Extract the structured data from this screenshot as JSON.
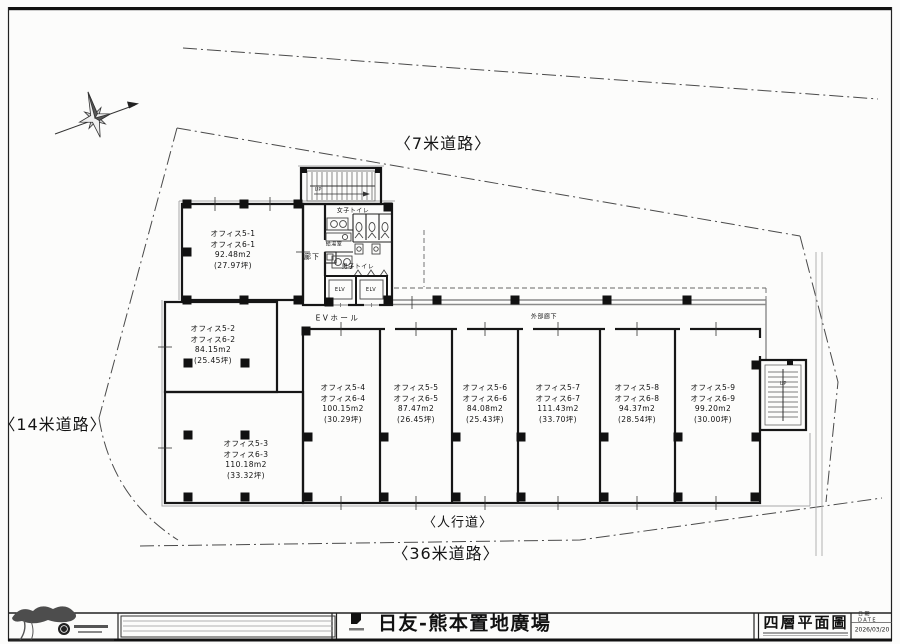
{
  "drawing": {
    "roads": {
      "north": "〈7米道路〉",
      "west": "〈14米道路〉",
      "sidewalk": "〈人行道〉",
      "south": "〈36米道路〉"
    },
    "rooms": {
      "exterior_corridor": "外部廊下",
      "ev_hall": "EVホール",
      "corridor": "廊下",
      "womens_toilet": "女子トイレ",
      "mens_toilet": "男子トイレ",
      "kitchenette": "給湯室",
      "elevator_1": "ELV",
      "elevator_2": "ELV",
      "stair_up_top": "UP",
      "stair_up_right": "UP"
    },
    "offices": [
      {
        "name_5": "オフィス5-1",
        "name_6": "オフィス6-1",
        "area": "92.48m2",
        "tsubo": "(27.97坪)"
      },
      {
        "name_5": "オフィス5-2",
        "name_6": "オフィス6-2",
        "area": "84.15m2",
        "tsubo": "(25.45坪)"
      },
      {
        "name_5": "オフィス5-3",
        "name_6": "オフィス6-3",
        "area": "110.18m2",
        "tsubo": "(33.32坪)"
      },
      {
        "name_5": "オフィス5-4",
        "name_6": "オフィス6-4",
        "area": "100.15m2",
        "tsubo": "(30.29坪)"
      },
      {
        "name_5": "オフィス5-5",
        "name_6": "オフィス6-5",
        "area": "87.47m2",
        "tsubo": "(26.45坪)"
      },
      {
        "name_5": "オフィス5-6",
        "name_6": "オフィス6-6",
        "area": "84.08m2",
        "tsubo": "(25.43坪)"
      },
      {
        "name_5": "オフィス5-7",
        "name_6": "オフィス6-7",
        "area": "111.43m2",
        "tsubo": "(33.70坪)"
      },
      {
        "name_5": "オフィス5-8",
        "name_6": "オフィス6-8",
        "area": "94.37m2",
        "tsubo": "(28.54坪)"
      },
      {
        "name_5": "オフィス5-9",
        "name_6": "オフィス6-9",
        "area": "99.20m2",
        "tsubo": "(30.00坪)"
      }
    ]
  },
  "titleblock": {
    "project": "日友-熊本置地廣場",
    "drawing_title": "四層平面圖",
    "date_label": "日期 DATE",
    "date_value": "2026/03/20"
  },
  "colors": {
    "paper": "#fcfcfb",
    "wall": "#161616",
    "thin_line": "#8a8a8a",
    "boundary": "#4a4a4a"
  }
}
